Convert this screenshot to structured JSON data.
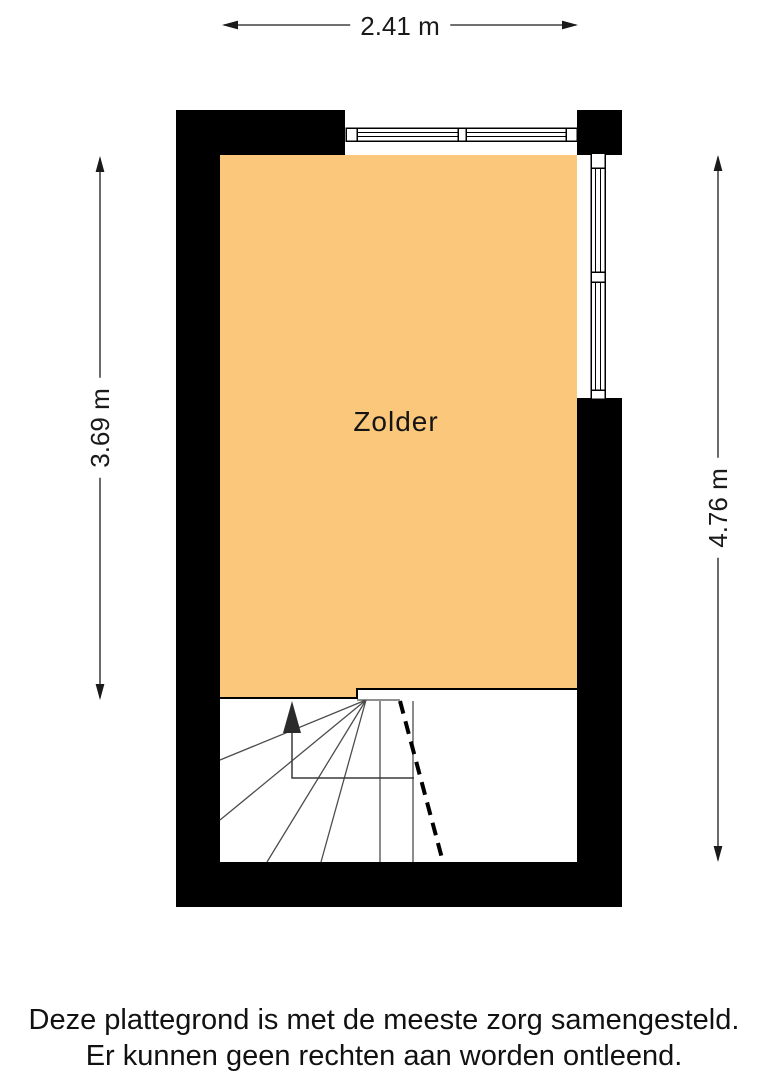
{
  "floorplan": {
    "room_label": "Zolder",
    "dimensions": {
      "width_top": "2.41 m",
      "height_left": "3.69 m",
      "height_right": "4.76 m"
    },
    "disclaimer": {
      "line1": "Deze plattegrond is met de meeste zorg samengesteld.",
      "line2": "Er kunnen geen rechten aan worden ontleend."
    },
    "colors": {
      "floor": "#FAC77B",
      "wall": "#000000",
      "background": "#FFFFFF",
      "stair_line": "#4D4D4D"
    }
  }
}
